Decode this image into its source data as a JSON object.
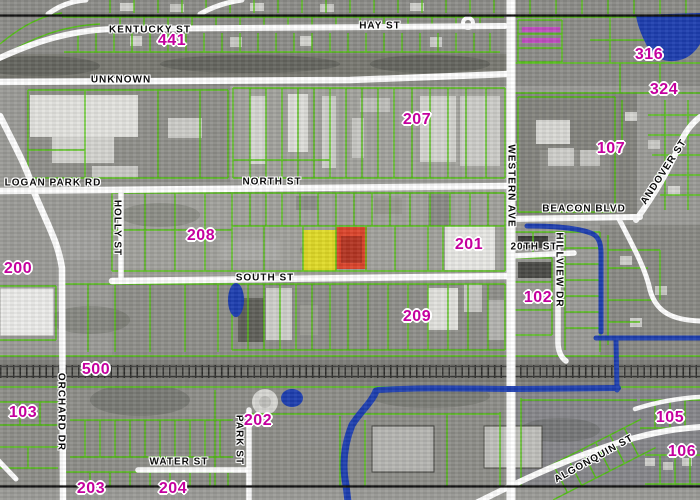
{
  "map": {
    "description": "Aerial parcel map with green lot lines, magenta block numbers and one yellow and one red highlighted parcel",
    "colors": {
      "parcel_line": "#4fc20d",
      "block_label": "#c4009e",
      "street_label": "#0b0b0b",
      "road": "#ffffff",
      "water": "#1d3eb0",
      "railroad_band": "#84847f",
      "selected_parcel_yellow": "#e6df1d",
      "selected_parcel_red": "#e23c22",
      "pink_parcel_line": "#c14ec1",
      "neatline": "#000000"
    },
    "highlighted_parcels": [
      {
        "id": "parcel-yellow",
        "fill": "#e6df1d"
      },
      {
        "id": "parcel-red",
        "fill": "#e23c22"
      }
    ],
    "street_labels": [
      {
        "text": "KENTUCKY ST",
        "x": 150,
        "y": 30,
        "rot": 0
      },
      {
        "text": "HAY ST",
        "x": 380,
        "y": 26,
        "rot": 0
      },
      {
        "text": "UNKNOWN",
        "x": 121,
        "y": 80,
        "rot": 0
      },
      {
        "text": "LOGAN PARK RD",
        "x": 53,
        "y": 183,
        "rot": 0
      },
      {
        "text": "NORTH ST",
        "x": 272,
        "y": 182,
        "rot": 0
      },
      {
        "text": "HOLLY ST",
        "x": 117,
        "y": 228,
        "rot": 90
      },
      {
        "text": "SOUTH ST",
        "x": 265,
        "y": 278,
        "rot": 0
      },
      {
        "text": "WESTERN AVE",
        "x": 511,
        "y": 186,
        "rot": 90
      },
      {
        "text": "BEACON BLVD",
        "x": 584,
        "y": 209,
        "rot": 0
      },
      {
        "text": "ANDOVER ST",
        "x": 664,
        "y": 172,
        "rot": -57
      },
      {
        "text": "20TH ST",
        "x": 534,
        "y": 247,
        "rot": 0
      },
      {
        "text": "HILLVIEW DR",
        "x": 559,
        "y": 270,
        "rot": 90
      },
      {
        "text": "ORCHARD DR",
        "x": 61,
        "y": 412,
        "rot": 90
      },
      {
        "text": "PARK ST",
        "x": 239,
        "y": 440,
        "rot": 90
      },
      {
        "text": "WATER ST",
        "x": 179,
        "y": 462,
        "rot": 0
      },
      {
        "text": "ALGONQUIN ST",
        "x": 594,
        "y": 459,
        "rot": -29
      }
    ],
    "block_labels": [
      {
        "text": "441",
        "x": 172,
        "y": 41
      },
      {
        "text": "316",
        "x": 649,
        "y": 55
      },
      {
        "text": "324",
        "x": 664,
        "y": 90
      },
      {
        "text": "207",
        "x": 417,
        "y": 120
      },
      {
        "text": "107",
        "x": 611,
        "y": 149
      },
      {
        "text": "208",
        "x": 201,
        "y": 236
      },
      {
        "text": "201",
        "x": 469,
        "y": 245
      },
      {
        "text": "200",
        "x": 18,
        "y": 269
      },
      {
        "text": "102",
        "x": 538,
        "y": 298
      },
      {
        "text": "209",
        "x": 417,
        "y": 317
      },
      {
        "text": "500",
        "x": 96,
        "y": 370
      },
      {
        "text": "103",
        "x": 23,
        "y": 413
      },
      {
        "text": "202",
        "x": 258,
        "y": 421
      },
      {
        "text": "105",
        "x": 670,
        "y": 418
      },
      {
        "text": "106",
        "x": 682,
        "y": 452
      },
      {
        "text": "203",
        "x": 91,
        "y": 489
      },
      {
        "text": "204",
        "x": 173,
        "y": 489
      }
    ]
  }
}
